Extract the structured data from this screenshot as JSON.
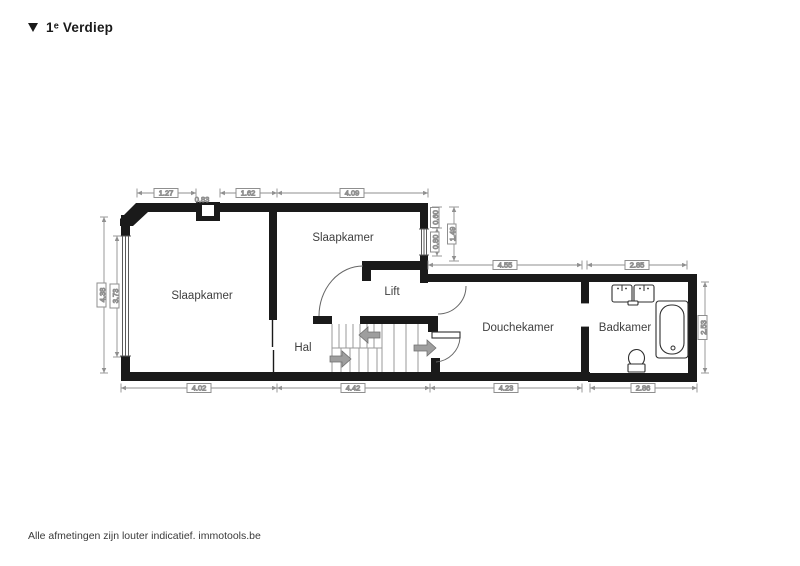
{
  "header": {
    "collapse_marker": "▼",
    "title": "1ᵉ Verdiep"
  },
  "floorplan": {
    "rooms": {
      "slaapkamer_left": {
        "label": "Slaapkamer"
      },
      "slaapkamer_right": {
        "label": "Slaapkamer"
      },
      "lift": {
        "label": "Lift"
      },
      "hal": {
        "label": "Hal"
      },
      "douchekamer": {
        "label": "Douchekamer"
      },
      "badkamer": {
        "label": "Badkamer"
      }
    },
    "dimensions": {
      "top_left_wall": "1.27",
      "top_chimney": "0.83",
      "top_mid_wall": "1.62",
      "top_right_wall": "4.09",
      "left_outer": "4.38",
      "left_window": "3.73",
      "right_upper_wall": "0.60",
      "right_upper_window": "0.80",
      "right_upper_total": "1.49",
      "douchekamer_width": "4.55",
      "badkamer_width_top": "2.85",
      "badkamer_height": "2.53",
      "bottom_1": "4.02",
      "bottom_2": "4.42",
      "bottom_3": "4.23",
      "bottom_4": "2.86"
    },
    "fixtures": [
      "double-sink",
      "bathtub",
      "toilet"
    ],
    "features": [
      "stairs",
      "lift-door-arc",
      "shower-room-doors",
      "windows",
      "chimney-recess"
    ]
  },
  "footer": {
    "disclaimer": "Alle afmetingen zijn louter indicatief. immotools.be"
  },
  "colors": {
    "background": "#ffffff",
    "wall": "#1a1a1a",
    "dimension": "#8f8f8f",
    "dimension_text": "#707070",
    "room_label": "#3f3f3f",
    "stair_line": "#9a9a9a",
    "arrow": "#9e9e9e",
    "fixture_outline": "#2e2e2e"
  }
}
